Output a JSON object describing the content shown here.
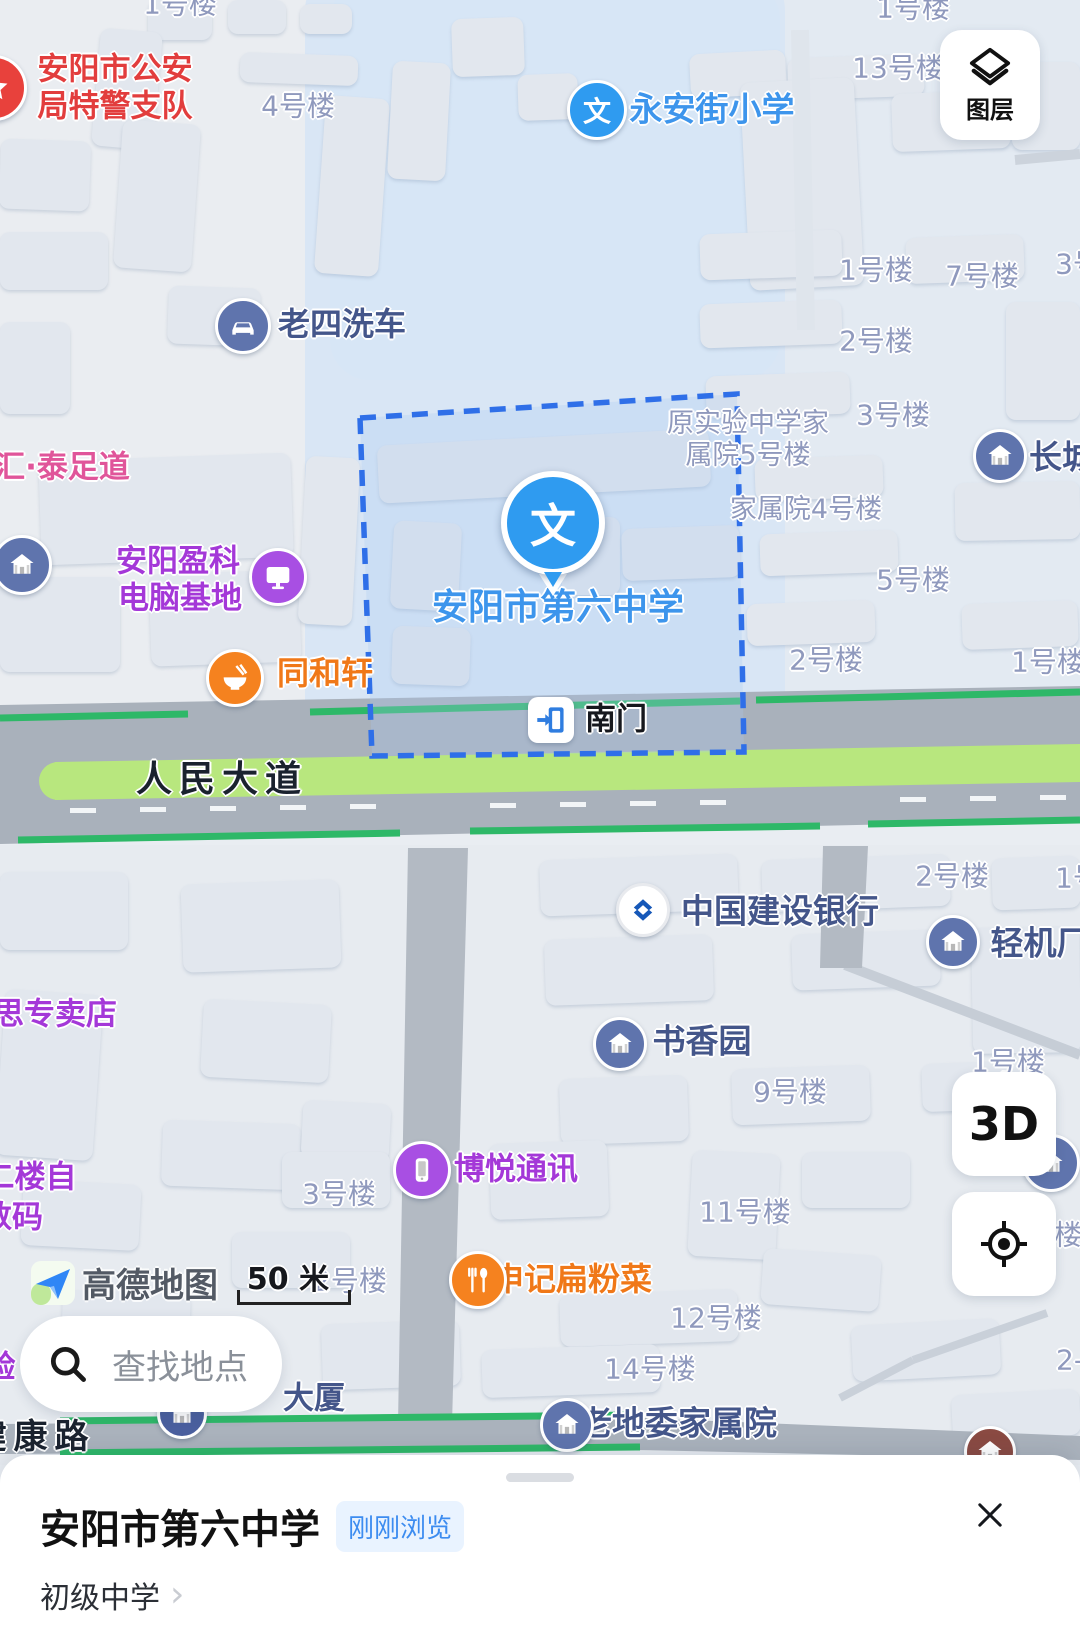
{
  "controls": {
    "layers_label": "图层",
    "threed_label": "3D"
  },
  "search": {
    "placeholder": "查找地点"
  },
  "scale": {
    "label": "50 米"
  },
  "logo": {
    "label": "高德地图"
  },
  "card": {
    "title": "安阳市第六中学",
    "badge": "刚刚浏览",
    "category": "初级中学",
    "chevron": "›"
  },
  "map": {
    "marker": {
      "glyph": "文",
      "label": "安阳市第六中学"
    },
    "gate": {
      "label": "南门"
    },
    "texts": [
      {
        "t": "1号楼",
        "x": 180,
        "y": 4,
        "c": "bldg",
        "i": false
      },
      {
        "t": "安阳市公安",
        "x": 115,
        "y": 70,
        "c": "red",
        "fs": 31,
        "i": true
      },
      {
        "t": "局特警支队",
        "x": 115,
        "y": 107,
        "c": "red",
        "fs": 31,
        "i": true
      },
      {
        "t": "4号楼",
        "x": 298,
        "y": 106,
        "c": "bldg",
        "i": false
      },
      {
        "t": "永安街小学",
        "x": 712,
        "y": 110,
        "c": "blue",
        "fs": 33,
        "i": true
      },
      {
        "t": "1号楼",
        "x": 913,
        "y": 8,
        "c": "bldg",
        "i": false
      },
      {
        "t": "13号楼",
        "x": 898,
        "y": 68,
        "c": "bldg",
        "i": false
      },
      {
        "t": "老四洗车",
        "x": 342,
        "y": 325,
        "c": "navy",
        "fs": 32,
        "i": true
      },
      {
        "t": "1号楼",
        "x": 876,
        "y": 270,
        "c": "bldg",
        "i": false
      },
      {
        "t": "7号楼",
        "x": 982,
        "y": 276,
        "c": "bldg",
        "i": false
      },
      {
        "t": "3号楼",
        "x": 1092,
        "y": 264,
        "c": "bldg",
        "i": false
      },
      {
        "t": "2号楼",
        "x": 876,
        "y": 341,
        "c": "bldg",
        "i": false
      },
      {
        "t": "3号楼",
        "x": 893,
        "y": 415,
        "c": "bldg",
        "i": false
      },
      {
        "t": "汇·泰足道",
        "x": 62,
        "y": 468,
        "c": "pink",
        "fs": 31,
        "i": true
      },
      {
        "t": "原实验中学家",
        "x": 748,
        "y": 424,
        "c": "bldg",
        "fs": 27,
        "i": false
      },
      {
        "t": "属院5号楼",
        "x": 748,
        "y": 456,
        "c": "bldg",
        "fs": 27,
        "i": false
      },
      {
        "t": "长城",
        "x": 1062,
        "y": 458,
        "c": "navy",
        "fs": 33,
        "i": true
      },
      {
        "t": "家属院4号楼",
        "x": 806,
        "y": 510,
        "c": "bldg",
        "fs": 27,
        "i": false
      },
      {
        "t": "安阳盈科",
        "x": 178,
        "y": 562,
        "c": "purple",
        "fs": 31,
        "i": true
      },
      {
        "t": "电脑基地",
        "x": 180,
        "y": 599,
        "c": "purple",
        "fs": 31,
        "i": true
      },
      {
        "t": "5号楼",
        "x": 913,
        "y": 580,
        "c": "bldg",
        "i": false
      },
      {
        "t": "同和轩",
        "x": 325,
        "y": 674,
        "c": "orange",
        "fs": 32,
        "i": true
      },
      {
        "t": "2号楼",
        "x": 826,
        "y": 660,
        "c": "bldg",
        "i": false
      },
      {
        "t": "1号楼",
        "x": 1048,
        "y": 662,
        "c": "bldg",
        "i": false
      },
      {
        "t": "安阳市第六中学",
        "x": 558,
        "y": 608,
        "c": "blue",
        "fs": 36,
        "i": true
      },
      {
        "t": "人民大道",
        "x": 222,
        "y": 780,
        "c": "road",
        "fs": 36,
        "i": false
      },
      {
        "t": "中国建设银行",
        "x": 780,
        "y": 912,
        "c": "navy",
        "fs": 33,
        "i": true
      },
      {
        "t": "2号楼",
        "x": 952,
        "y": 876,
        "c": "bldg",
        "i": false
      },
      {
        "t": "1号楼",
        "x": 1092,
        "y": 878,
        "c": "bldg",
        "i": false
      },
      {
        "t": "轻机厂",
        "x": 1040,
        "y": 944,
        "c": "navy",
        "fs": 33,
        "i": true
      },
      {
        "t": "书香园",
        "x": 702,
        "y": 1042,
        "c": "navy",
        "fs": 33,
        "i": true
      },
      {
        "t": "1号楼",
        "x": 1008,
        "y": 1062,
        "c": "bldg",
        "i": false
      },
      {
        "t": "9号楼",
        "x": 790,
        "y": 1092,
        "c": "bldg",
        "i": false
      },
      {
        "t": "思专卖店",
        "x": 55,
        "y": 1015,
        "c": "purple",
        "fs": 31,
        "i": true
      },
      {
        "t": "博悦通讯",
        "x": 516,
        "y": 1170,
        "c": "purple",
        "fs": 31,
        "i": true
      },
      {
        "t": "3号楼",
        "x": 339,
        "y": 1194,
        "c": "bldg",
        "i": false
      },
      {
        "t": "11号楼",
        "x": 745,
        "y": 1212,
        "c": "bldg",
        "i": false
      },
      {
        "t": "二楼自",
        "x": 30,
        "y": 1178,
        "c": "purple",
        "fs": 31,
        "i": true
      },
      {
        "t": "数码",
        "x": 12,
        "y": 1218,
        "c": "purple",
        "fs": 31,
        "i": true
      },
      {
        "t": "楼",
        "x": 1068,
        "y": 1235,
        "c": "bldg",
        "i": false
      },
      {
        "t": "申记扁粉菜",
        "x": 572,
        "y": 1280,
        "c": "orange",
        "fs": 32,
        "i": true
      },
      {
        "t": "2号楼",
        "x": 350,
        "y": 1281,
        "c": "bldg",
        "i": false
      },
      {
        "t": "12号楼",
        "x": 716,
        "y": 1318,
        "c": "bldg",
        "i": false
      },
      {
        "t": "14号楼",
        "x": 650,
        "y": 1369,
        "c": "bldg",
        "i": false
      },
      {
        "t": "2-",
        "x": 1070,
        "y": 1360,
        "c": "bldg",
        "i": false
      },
      {
        "t": "大厦",
        "x": 314,
        "y": 1399,
        "c": "navy",
        "fs": 31,
        "i": false
      },
      {
        "t": "验",
        "x": 0,
        "y": 1368,
        "c": "purple",
        "fs": 31,
        "i": true
      },
      {
        "t": "老地委家属院",
        "x": 678,
        "y": 1424,
        "c": "navy",
        "fs": 33,
        "i": true
      },
      {
        "t": "健康路",
        "x": 34,
        "y": 1438,
        "c": "road",
        "fs": 34,
        "i": false
      }
    ],
    "pois": [
      {
        "name": "police-star-icon",
        "x": -6,
        "y": 88,
        "r": 30,
        "bg": "#e8413c",
        "g": "star"
      },
      {
        "name": "school-poi-icon",
        "x": 597,
        "y": 110,
        "r": 27,
        "bg": "#2f9bf0",
        "g": "wen"
      },
      {
        "name": "car-wash-icon",
        "x": 243,
        "y": 326,
        "r": 25,
        "bg": "#5f74ad",
        "g": "car"
      },
      {
        "name": "house-icon",
        "x": 22,
        "y": 565,
        "r": 27,
        "bg": "#5f74ad",
        "g": "house"
      },
      {
        "name": "computer-icon",
        "x": 278,
        "y": 577,
        "r": 26,
        "bg": "#a84fe3",
        "g": "monitor"
      },
      {
        "name": "restaurant-icon",
        "x": 235,
        "y": 678,
        "r": 26,
        "bg": "#f5821f",
        "g": "bowl"
      },
      {
        "name": "estate-icon",
        "x": 1000,
        "y": 456,
        "r": 24,
        "bg": "#5f74ad",
        "g": "house"
      },
      {
        "name": "bank-icon",
        "x": 643,
        "y": 910,
        "r": 24,
        "bg": "#ffffff",
        "g": "ccb"
      },
      {
        "name": "estate-icon",
        "x": 953,
        "y": 942,
        "r": 24,
        "bg": "#5f74ad",
        "g": "house"
      },
      {
        "name": "estate-icon",
        "x": 620,
        "y": 1044,
        "r": 24,
        "bg": "#5f74ad",
        "g": "house"
      },
      {
        "name": "estate-icon",
        "x": 1051,
        "y": 1163,
        "r": 26,
        "bg": "#5f74ad",
        "g": "house"
      },
      {
        "name": "phone-icon",
        "x": 422,
        "y": 1170,
        "r": 26,
        "bg": "#a84fe3",
        "g": "phone"
      },
      {
        "name": "food-icon",
        "x": 478,
        "y": 1280,
        "r": 26,
        "bg": "#f5821f",
        "g": "forkspoon"
      },
      {
        "name": "building-icon",
        "x": 182,
        "y": 1414,
        "r": 22,
        "bg": "#4a5f9e",
        "g": "house"
      },
      {
        "name": "estate-icon",
        "x": 567,
        "y": 1425,
        "r": 24,
        "bg": "#5f74ad",
        "g": "house"
      },
      {
        "name": "poi-icon",
        "x": 990,
        "y": 1452,
        "r": 23,
        "bg": "#8a4a42",
        "g": "house"
      }
    ]
  }
}
